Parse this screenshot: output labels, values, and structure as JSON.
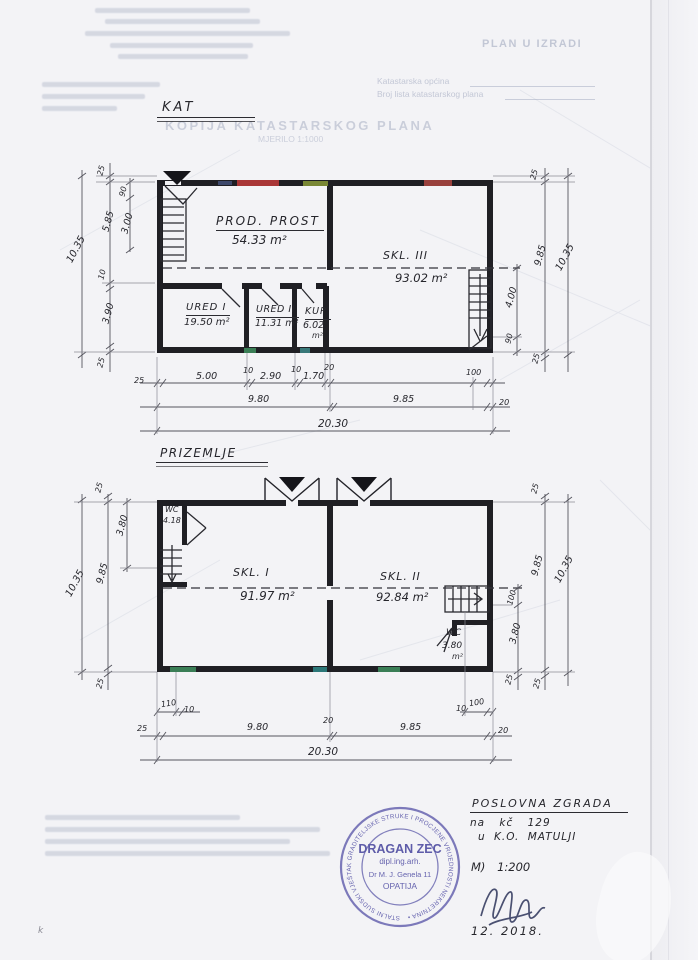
{
  "letterhead": {
    "status_note": "PLAN U IZRADI",
    "field_1": "Katastarska općina",
    "field_2": "Broj lista katastarskog plana",
    "doc_title": "KOPIJA KATASTARSKOG PLANA",
    "doc_scale": "MJERILO 1:1000"
  },
  "kat": {
    "label": "KAT",
    "rooms": [
      {
        "name": "PROD. PROST",
        "area": "54.33 m²"
      },
      {
        "name": "SKL. III",
        "area": "93.02 m²"
      },
      {
        "name": "URED I",
        "area": "19.50 m²"
      },
      {
        "name": "URED II",
        "area": "11.31 m²"
      },
      {
        "name": "KUP",
        "area": "6.02",
        "unit": "m²"
      }
    ],
    "dims": {
      "bottom_row1": [
        "25",
        "5.00",
        "10",
        "2.90",
        "10",
        "1.70",
        "20",
        "100"
      ],
      "bottom_row2": [
        "9.80",
        "9.85",
        "20"
      ],
      "bottom_total": "20.30",
      "left_chain": [
        "25",
        "5.85",
        "10",
        "3.90",
        "25"
      ],
      "left_sub": [
        "90",
        "3.00"
      ],
      "left_outer": "10.35",
      "right_chain": [
        "25",
        "9.85",
        "25"
      ],
      "right_sub": [
        "4.00",
        "90"
      ],
      "right_outer": "10.35"
    }
  },
  "prizemlje": {
    "label": "PRIZEMLJE",
    "rooms": [
      {
        "name": "WC",
        "area": "4.18"
      },
      {
        "name": "SKL. I",
        "area": "91.97 m²"
      },
      {
        "name": "SKL. II",
        "area": "92.84 m²"
      },
      {
        "name": "WC",
        "area": "3.80",
        "unit": "m²"
      }
    ],
    "dims": {
      "mini_left": [
        "110",
        "10"
      ],
      "mini_right": [
        "10",
        "100"
      ],
      "bottom_row1": [
        "25",
        "9.80",
        "20",
        "9.85",
        "20"
      ],
      "bottom_total": "20.30",
      "left_chain": [
        "25",
        "9.85",
        "25"
      ],
      "left_sub": "3.80",
      "left_outer": "10.35",
      "right_chain": [
        "25",
        "9.85",
        "25"
      ],
      "right_sub": [
        "100",
        "3.80",
        "25"
      ],
      "right_outer": "10.35"
    }
  },
  "stamp": {
    "ring_text": "STALNI SUDSKI VJEŠTAK GRADITELJSKE STRUKE I PROCJENE VRIJEDNOSTI NEKRETNINA •",
    "name": "DRAGAN ZEC",
    "title": "dipl.ing.arh.",
    "address": "Dr M. J. Genela 11",
    "city": "OPATIJA"
  },
  "notes": {
    "heading": "POSLOVNA ZGRADA",
    "line_parcel": "na kč 129",
    "line_municipality": "u K.O. MATULJI",
    "scale": "M)  1:200",
    "date": "12. 2018.",
    "corner_mark": "k"
  }
}
